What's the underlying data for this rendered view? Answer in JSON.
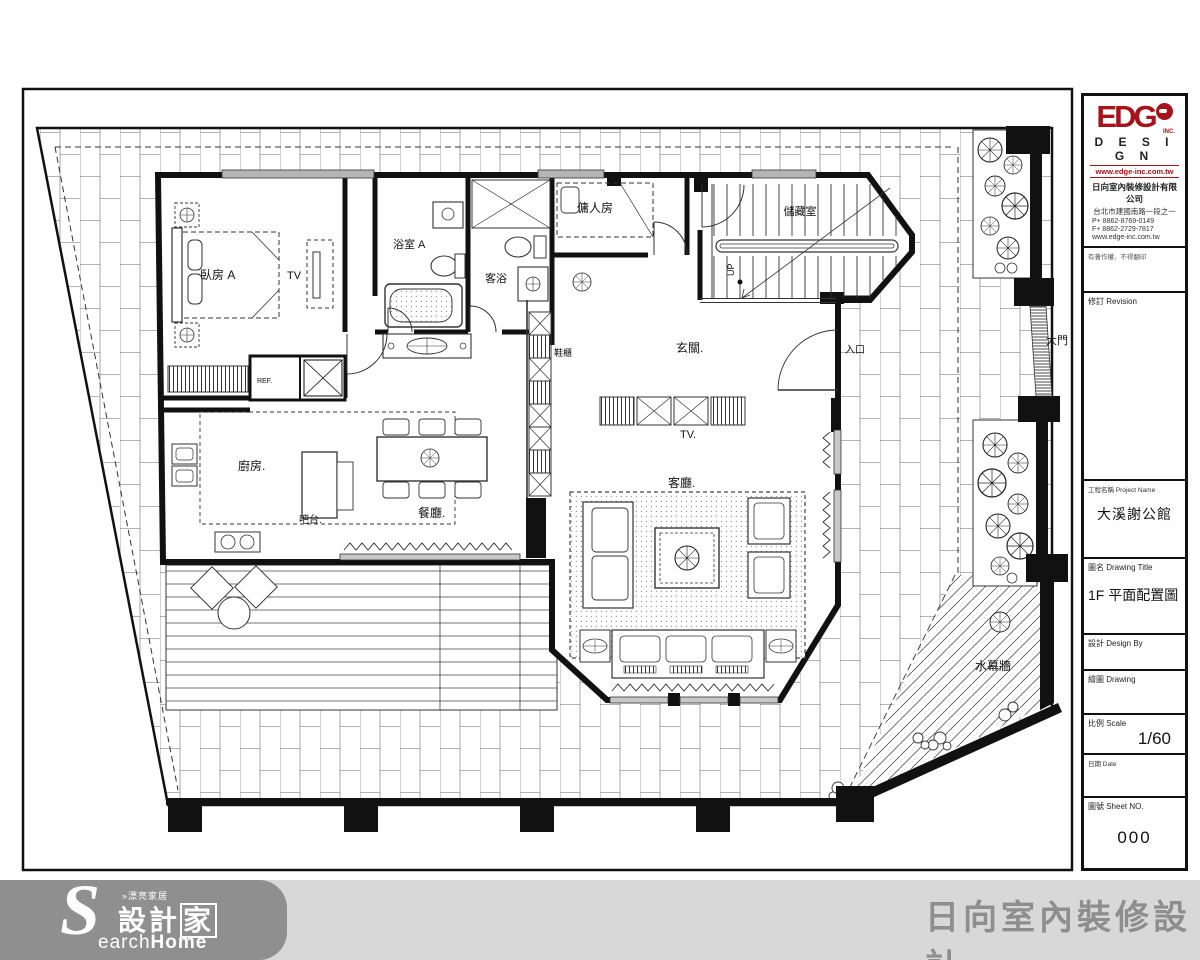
{
  "plan": {
    "labels": {
      "bedroom_a": "臥房 A",
      "tv_bed": "TV",
      "bath_a": "浴室 A",
      "guest_bath": "客浴",
      "maid": "傭人房",
      "storage": "儲藏室",
      "foyer": "玄關.",
      "entrance": "入口",
      "shoe": "鞋櫃",
      "ref": "REF.",
      "kitchen": "廚房.",
      "bar": "吧台.",
      "dining": "餐廳.",
      "tv_living": "TV.",
      "living": "客廳.",
      "gate": "大門",
      "water_wall": "水幕牆",
      "up": "UP"
    }
  },
  "title_block": {
    "logo_edge": "EDG",
    "logo_inc": "INC.",
    "logo_design": "D E S I G N",
    "logo_site": "www.edge-inc.com.tw",
    "co_name": "日向室內裝修設計有限公司",
    "co_addr": "台北市建國南路一段之一",
    "co_phone": "P+ 8862-8769-0149",
    "co_fax": "F+ 8862-2729-7817",
    "co_site": "www.edge-inc.com.tw",
    "note": "有著作權．不得翻印",
    "revision": "修訂 Revision",
    "project_label": "工程名稱 Project Name",
    "project_name": "大溪謝公館",
    "title_label": "圖名 Drawing Title",
    "title_value": "1F 平面配置圖",
    "design_label": "設計 Design By",
    "drawing_label": "繪圖 Drawing",
    "scale_label": "比例 Scale",
    "scale_value": "1/60",
    "date_label": "日期 Date",
    "sheet_label": "圖號 Sheet NO.",
    "sheet_value": "000"
  },
  "footer": {
    "s": "S",
    "top": "»漂亮家居",
    "main_prefix": "設計",
    "main_jia": "家",
    "sub_light": "earch",
    "sub_bold": "Home",
    "company": "日向室內裝修設計"
  },
  "colors": {
    "logo_red": "#a8121a",
    "footer_bar": "#d8d8d8",
    "footer_blob": "#8f8f8f",
    "footer_text": "#8e8e8e",
    "line": "#111111"
  }
}
